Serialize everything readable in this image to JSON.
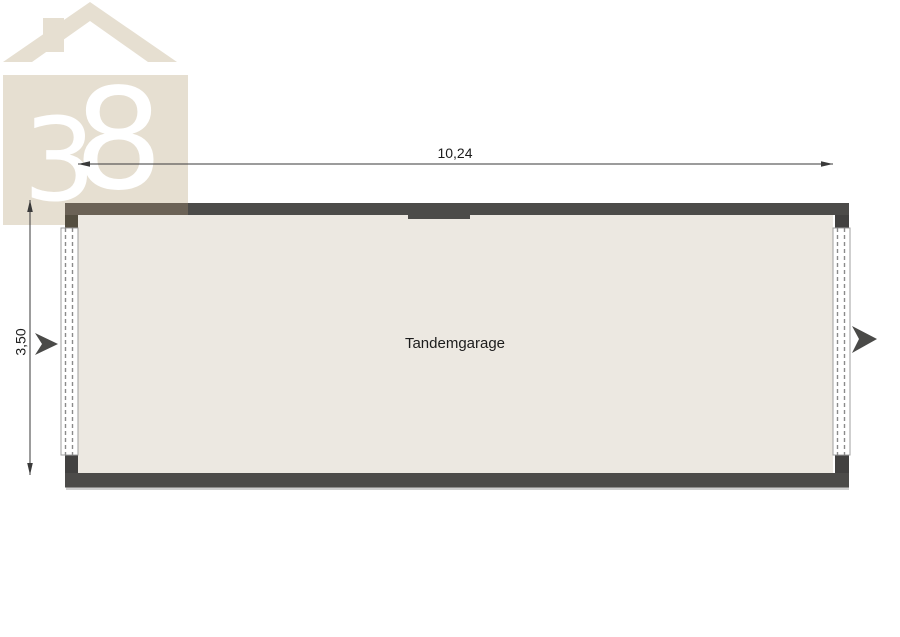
{
  "logo": {
    "digits": [
      "3",
      "8"
    ],
    "description": "house-logo-38"
  },
  "dimensions": {
    "width": "10,24",
    "height": "3,50"
  },
  "room": {
    "label": "Tandemgarage"
  },
  "colors": {
    "logo_beige": "#e6dfd1",
    "logo_text": "#ffffff",
    "wall": "#4c4b49",
    "wall_over_logo": "#6b6256",
    "corner_post": "#424140",
    "corner_post_tinted": "#544e40",
    "interior": "#ece8e1",
    "door_fill": "#ffffff",
    "door_edge": "#9f9f9f",
    "door_dash": "#8a8a8a",
    "dimension_line": "#3a3a3a",
    "arrow": "#4a4a48",
    "shadow": "#cfcfcf",
    "text": "#1c1c1c"
  }
}
